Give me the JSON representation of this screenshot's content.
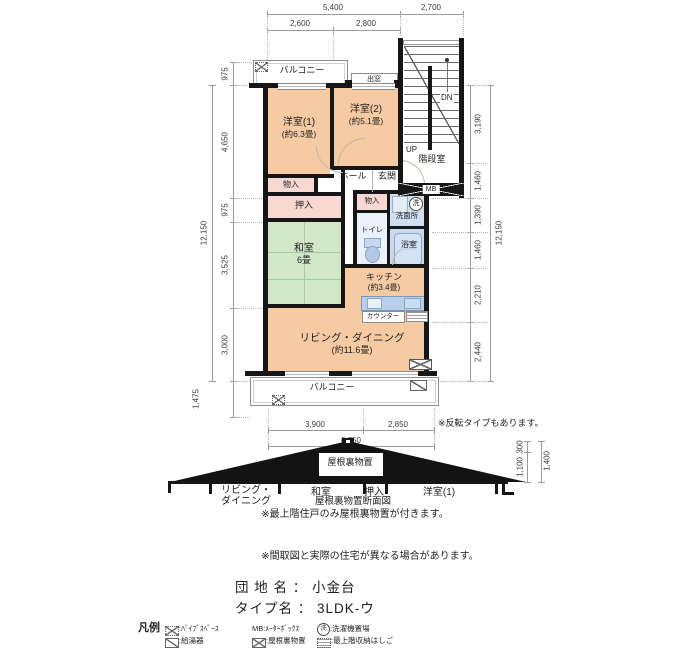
{
  "dims": {
    "top_total_left": "5,400",
    "top_total_right": "2,700",
    "top_sub_left": "2,600",
    "top_sub_right": "2,800",
    "left_balcony": "975",
    "left_room": "4,650",
    "left_closet": "975",
    "left_washitsu": "3,525",
    "left_living": "3,000",
    "left_balcony2": "1,475",
    "left_total": "12,150",
    "right_stair": "3,190",
    "right_entry": "1,460",
    "right_wash": "1,390",
    "right_bath": "1,460",
    "right_kitchen": "2,210",
    "right_living": "2,440",
    "right_total": "12,150",
    "bottom_left": "3,900",
    "bottom_right": "2,850",
    "bottom_total": "6,750"
  },
  "plan": {
    "balcony_top": "バルコニー",
    "bay_window": "出窓",
    "yoshitsu1": "洋室(1)",
    "yoshitsu1_size": "(約6.3畳)",
    "yoshitsu2": "洋室(2)",
    "yoshitsu2_size": "(約5.1畳)",
    "hall": "ホール",
    "genkan": "玄関",
    "dn": "DN",
    "up": "UP",
    "stair_room": "階段室",
    "mb": "MB",
    "monoire_a": "物入",
    "oshiire": "押入",
    "monoire_b": "物入",
    "washitsu": "和室",
    "washitsu_size": "6畳",
    "senmenjo": "洗面所",
    "laundry_mark": "洗",
    "toilet": "トイレ",
    "bath": "浴室",
    "kitchen": "キッチン",
    "kitchen_size": "(約3.4畳)",
    "counter": "カウンター",
    "living": "リビング・ダイニング",
    "living_size": "(約11.6畳)",
    "balcony_bottom": "バルコニー",
    "note_reverse": "※反転タイプもあります。"
  },
  "section": {
    "attic": "屋根裏物置",
    "room_living_1": "リビング・",
    "room_living_2": "ダイニング",
    "room_washitsu": "和室",
    "room_oshiire": "押入",
    "room_yoshitsu1": "洋室(1)",
    "caption": "屋根裏物置断面図",
    "note": "※最上階住戸のみ屋根裏物置が付きます。",
    "dim_300": "300",
    "dim_1100": "1,100",
    "dim_1400": "1,400"
  },
  "info": {
    "disclaimer": "※間取図と実際の住宅が異なる場合があります。",
    "danchi_line": "団 地 名 ： 小金台",
    "type_line": "タイプ名 ： 3LDK-ウ"
  },
  "legend": {
    "title": "凡例",
    "pipe_space": ":ﾊﾟｲﾌﾟｽﾍﾟｰｽ",
    "mb": "MB:ﾒｰﾀｰﾎﾞｯｸｽ",
    "laundry_mark": "洗",
    "laundry": ":洗濯機置場",
    "water_heater": ":給湯器",
    "attic": ":屋根裏物置",
    "ladder": ":最上階収納はしご"
  }
}
